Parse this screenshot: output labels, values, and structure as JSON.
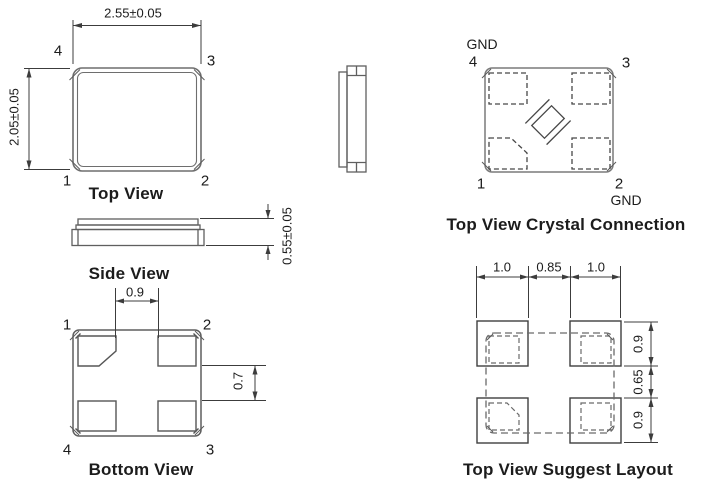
{
  "document": {
    "kind": "crystal-package-mechanical-drawing",
    "background_color": "#ffffff",
    "line_color": "#6e6e6e",
    "dimension_color": "#3c3c3c",
    "text_color": "#1c1c1c"
  },
  "views": {
    "top_view": {
      "title": "Top View",
      "width_dim": "2.55±0.05",
      "height_dim": "2.05±0.05",
      "pins": {
        "top_left": "4",
        "top_right": "3",
        "bottom_left": "1",
        "bottom_right": "2"
      }
    },
    "side_view": {
      "title": "Side View",
      "height_dim": "0.55±0.05"
    },
    "bottom_view": {
      "title": "Bottom View",
      "pad_gap_x_dim": "0.9",
      "pad_gap_y_dim": "0.7",
      "pins": {
        "top_left": "1",
        "top_right": "2",
        "bottom_left": "4",
        "bottom_right": "3"
      }
    },
    "crystal_connection": {
      "title": "Top View Crystal Connection",
      "gnd_top": "GND",
      "gnd_bottom": "GND",
      "pins": {
        "top_left": "4",
        "top_right": "3",
        "bottom_left": "1",
        "bottom_right": "2"
      }
    },
    "suggest_layout": {
      "title": "Top View Suggest Layout",
      "dims_top": [
        "1.0",
        "0.85",
        "1.0"
      ],
      "dims_right": [
        "0.9",
        "0.65",
        "0.9"
      ]
    }
  }
}
